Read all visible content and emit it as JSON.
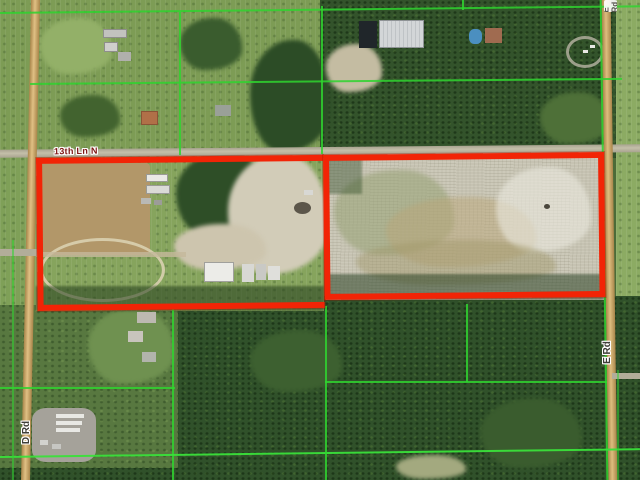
{
  "map": {
    "road_labels": {
      "horizontal_street": "13th Ln N",
      "left_road": "D Rd",
      "right_road": "E Rd",
      "right_road_top_partial": "E Rd"
    },
    "colors": {
      "highlight_outline": "#f22406",
      "parcel_line_green": "#2fd32f",
      "street_label": "#7c1512",
      "road_label": "#3e3e38"
    }
  }
}
